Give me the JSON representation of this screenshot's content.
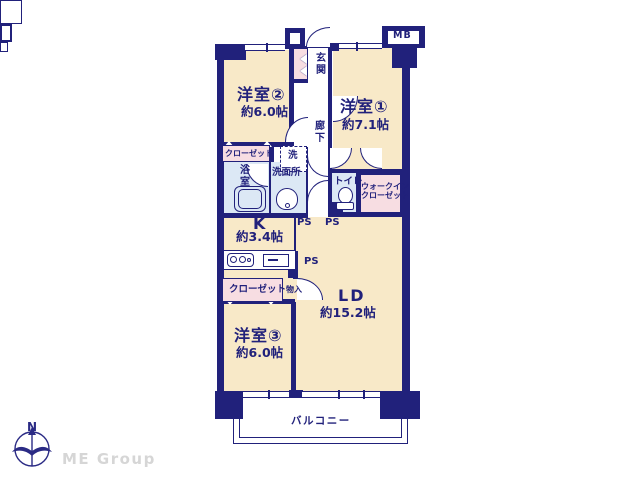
{
  "colors": {
    "wall_navy": "#21217b",
    "room_cream": "#f8e9c8",
    "closet_pink": "#f7dde2",
    "wet_blue": "#dce8f5",
    "brand_gray": "#d6d6d6"
  },
  "rooms": {
    "yoshitsu2": {
      "name": "洋室②",
      "size": "約6.0帖"
    },
    "yoshitsu1": {
      "name": "洋室①",
      "size": "約7.1帖"
    },
    "yoshitsu3": {
      "name": "洋室③",
      "size": "約6.0帖"
    },
    "ld": {
      "name": "LD",
      "size": "約15.2帖"
    },
    "kitchen": {
      "name": "K",
      "size": "約3.4帖"
    }
  },
  "labels": {
    "genkan": "玄関",
    "rouka": "廊下",
    "closet": "クローゼット",
    "laundry": "洗",
    "bath": "浴室",
    "washroom": "洗面所",
    "toilet": "トイレ",
    "wic": "ウォークイン\nクローゼット",
    "monoire": "物入",
    "balcony": "バルコニー",
    "ps": "PS",
    "mb": "MB"
  },
  "logo": {
    "north": "N",
    "brand": "ME Group"
  }
}
